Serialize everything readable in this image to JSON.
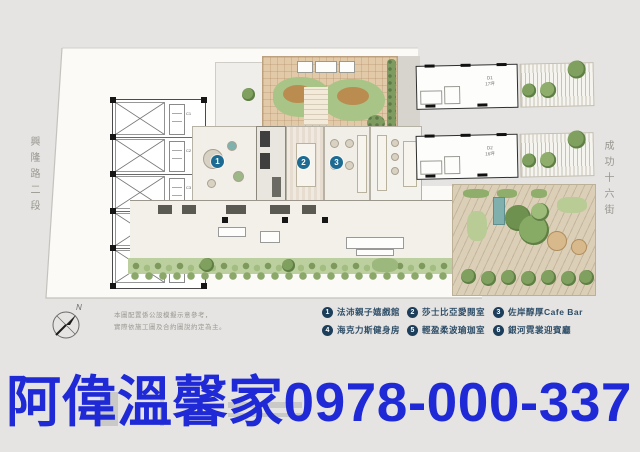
{
  "streets": {
    "left": "興隆路二段",
    "right": "成功十六街"
  },
  "compass": {
    "label": "N"
  },
  "disclaimer": {
    "line1": "本圖配置係公設模擬示意參考，",
    "line2": "實際依施工圖及合約圖說約定為主。"
  },
  "legend": {
    "items": [
      {
        "num": "1",
        "label": "法沛親子嬉戲館"
      },
      {
        "num": "2",
        "label": "莎士比亞愛閱室"
      },
      {
        "num": "3",
        "label": "佐岸醇厚Cafe Bar"
      },
      {
        "num": "4",
        "label": "海克力斯健身房"
      },
      {
        "num": "5",
        "label": "輕盈柔波瑜珈室"
      },
      {
        "num": "6",
        "label": "銀河霓裳迎賓廳"
      }
    ]
  },
  "plan": {
    "badges": [
      "1",
      "2",
      "3",
      "4",
      "5",
      "6"
    ],
    "left_units": [
      "C1",
      "C2",
      "C3",
      "C4",
      "C5"
    ],
    "store_units": [
      {
        "code": "D1",
        "area": "17坪"
      },
      {
        "code": "D2",
        "area": "16坪"
      }
    ]
  },
  "overlay": {
    "text": "阿偉溫馨家0978-000-337"
  },
  "colors": {
    "background": "#e5e4e2",
    "overlay_blue": "#1f2ad6",
    "legend_navy": "#1d3e5b",
    "plan_badge_teal": "#1d6b93",
    "lawn_green": "#a9c487",
    "paving_tan": "#e2c9a7"
  }
}
